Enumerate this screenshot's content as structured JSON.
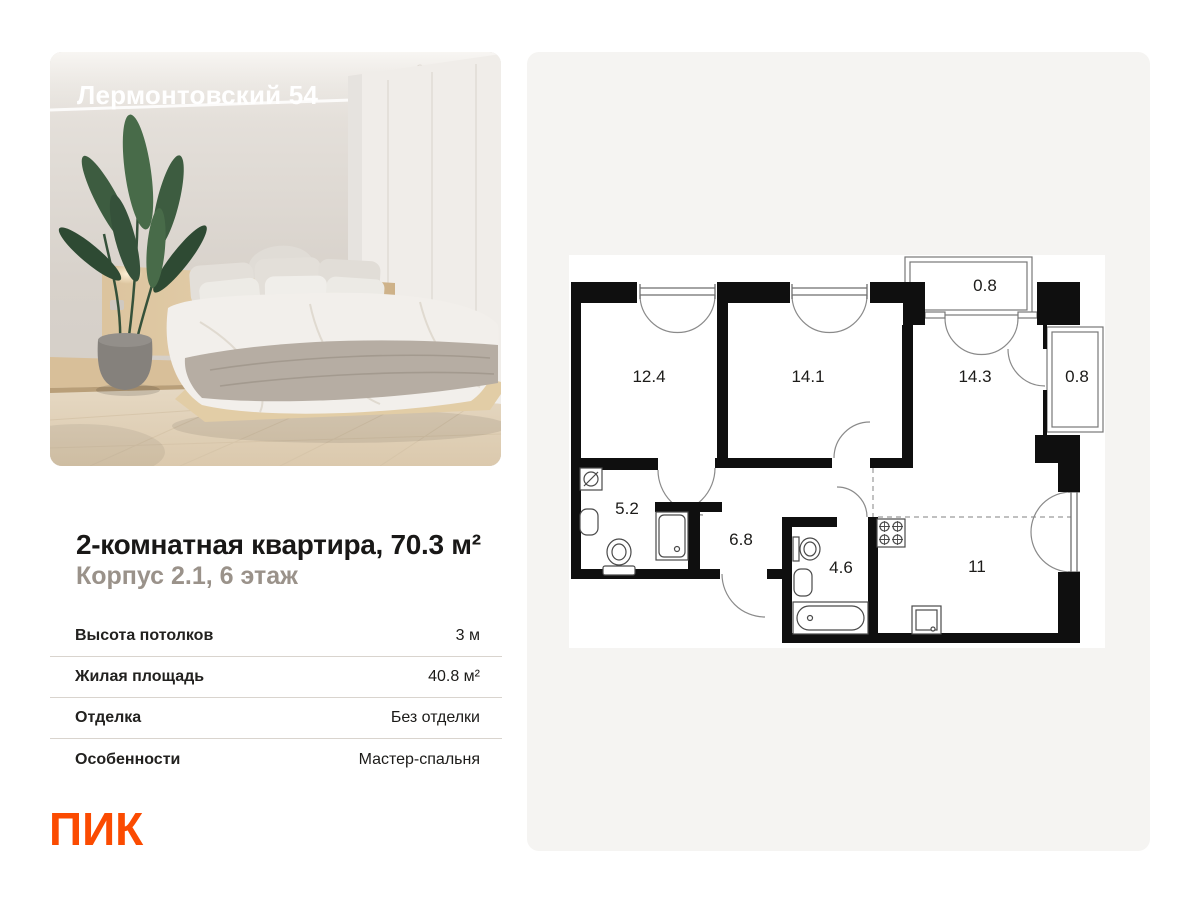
{
  "photo_card": {
    "overlay_title": "Лермонтовский 54"
  },
  "listing": {
    "title": "2-комнатная квартира, 70.3 м²",
    "subtitle": "Корпус 2.1, 6 этаж",
    "specs": [
      {
        "label": "Высота потолков",
        "value": "3 м"
      },
      {
        "label": "Жилая площадь",
        "value": "40.8 м²"
      },
      {
        "label": "Отделка",
        "value": "Без отделки"
      },
      {
        "label": "Особенности",
        "value": "Мастер-спальня"
      }
    ]
  },
  "logo": {
    "text": "ПИК"
  },
  "floor_plan": {
    "rooms": [
      {
        "id": "bedroom-1",
        "area": "12.4"
      },
      {
        "id": "bedroom-2",
        "area": "14.1"
      },
      {
        "id": "living-room",
        "area": "14.3"
      },
      {
        "id": "balcony-top",
        "area": "0.8"
      },
      {
        "id": "balcony-right",
        "area": "0.8"
      },
      {
        "id": "bathroom-1",
        "area": "5.2"
      },
      {
        "id": "hallway",
        "area": "6.8"
      },
      {
        "id": "bathroom-2",
        "area": "4.6"
      },
      {
        "id": "kitchen-zone",
        "area": "11"
      }
    ],
    "icons": [
      "washing-machine-icon",
      "sink-icon",
      "toilet-icon",
      "shower-icon",
      "bathtub-icon",
      "stove-icon",
      "kitchen-sink-icon"
    ]
  },
  "colors": {
    "brand_orange": "#fb4b01",
    "title": "#191817",
    "subtitle": "#9a928a",
    "card_bg": "#f5f4f2",
    "divider": "#d9d4ce",
    "wall": "#0f0f0f"
  }
}
